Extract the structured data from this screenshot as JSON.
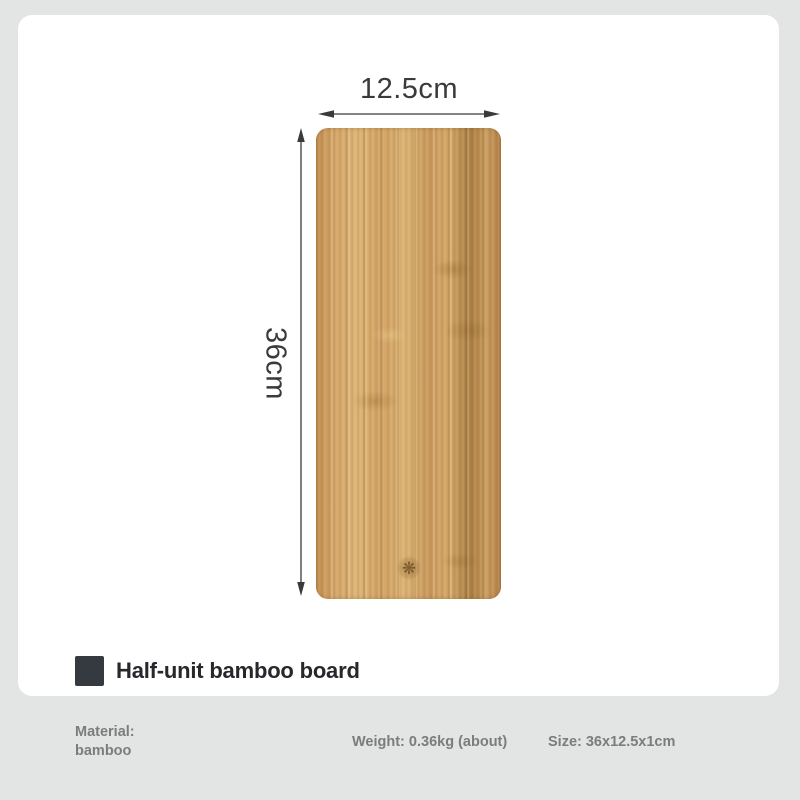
{
  "product": {
    "title": "Half-unit bamboo board",
    "stamp_icon": "❋"
  },
  "dimensions": {
    "width_label": "12.5cm",
    "height_label": "36cm"
  },
  "specs": {
    "material_label": "Material:",
    "material_value": "bamboo",
    "weight": "Weight: 0.36kg (about)",
    "size": "Size: 36x12.5x1cm"
  },
  "theme": {
    "page_background": "#e3e4e4",
    "card_background": "#ffffff",
    "title_color": "#26282b",
    "swatch_color": "#343a40",
    "dimension_color": "#3a3a3a",
    "footer_text_color": "#7c7c7c",
    "wood_light": "#dcb476",
    "wood_mid": "#c99a5e",
    "wood_dark": "#a87c43",
    "stamp_color": "#7a5526"
  }
}
